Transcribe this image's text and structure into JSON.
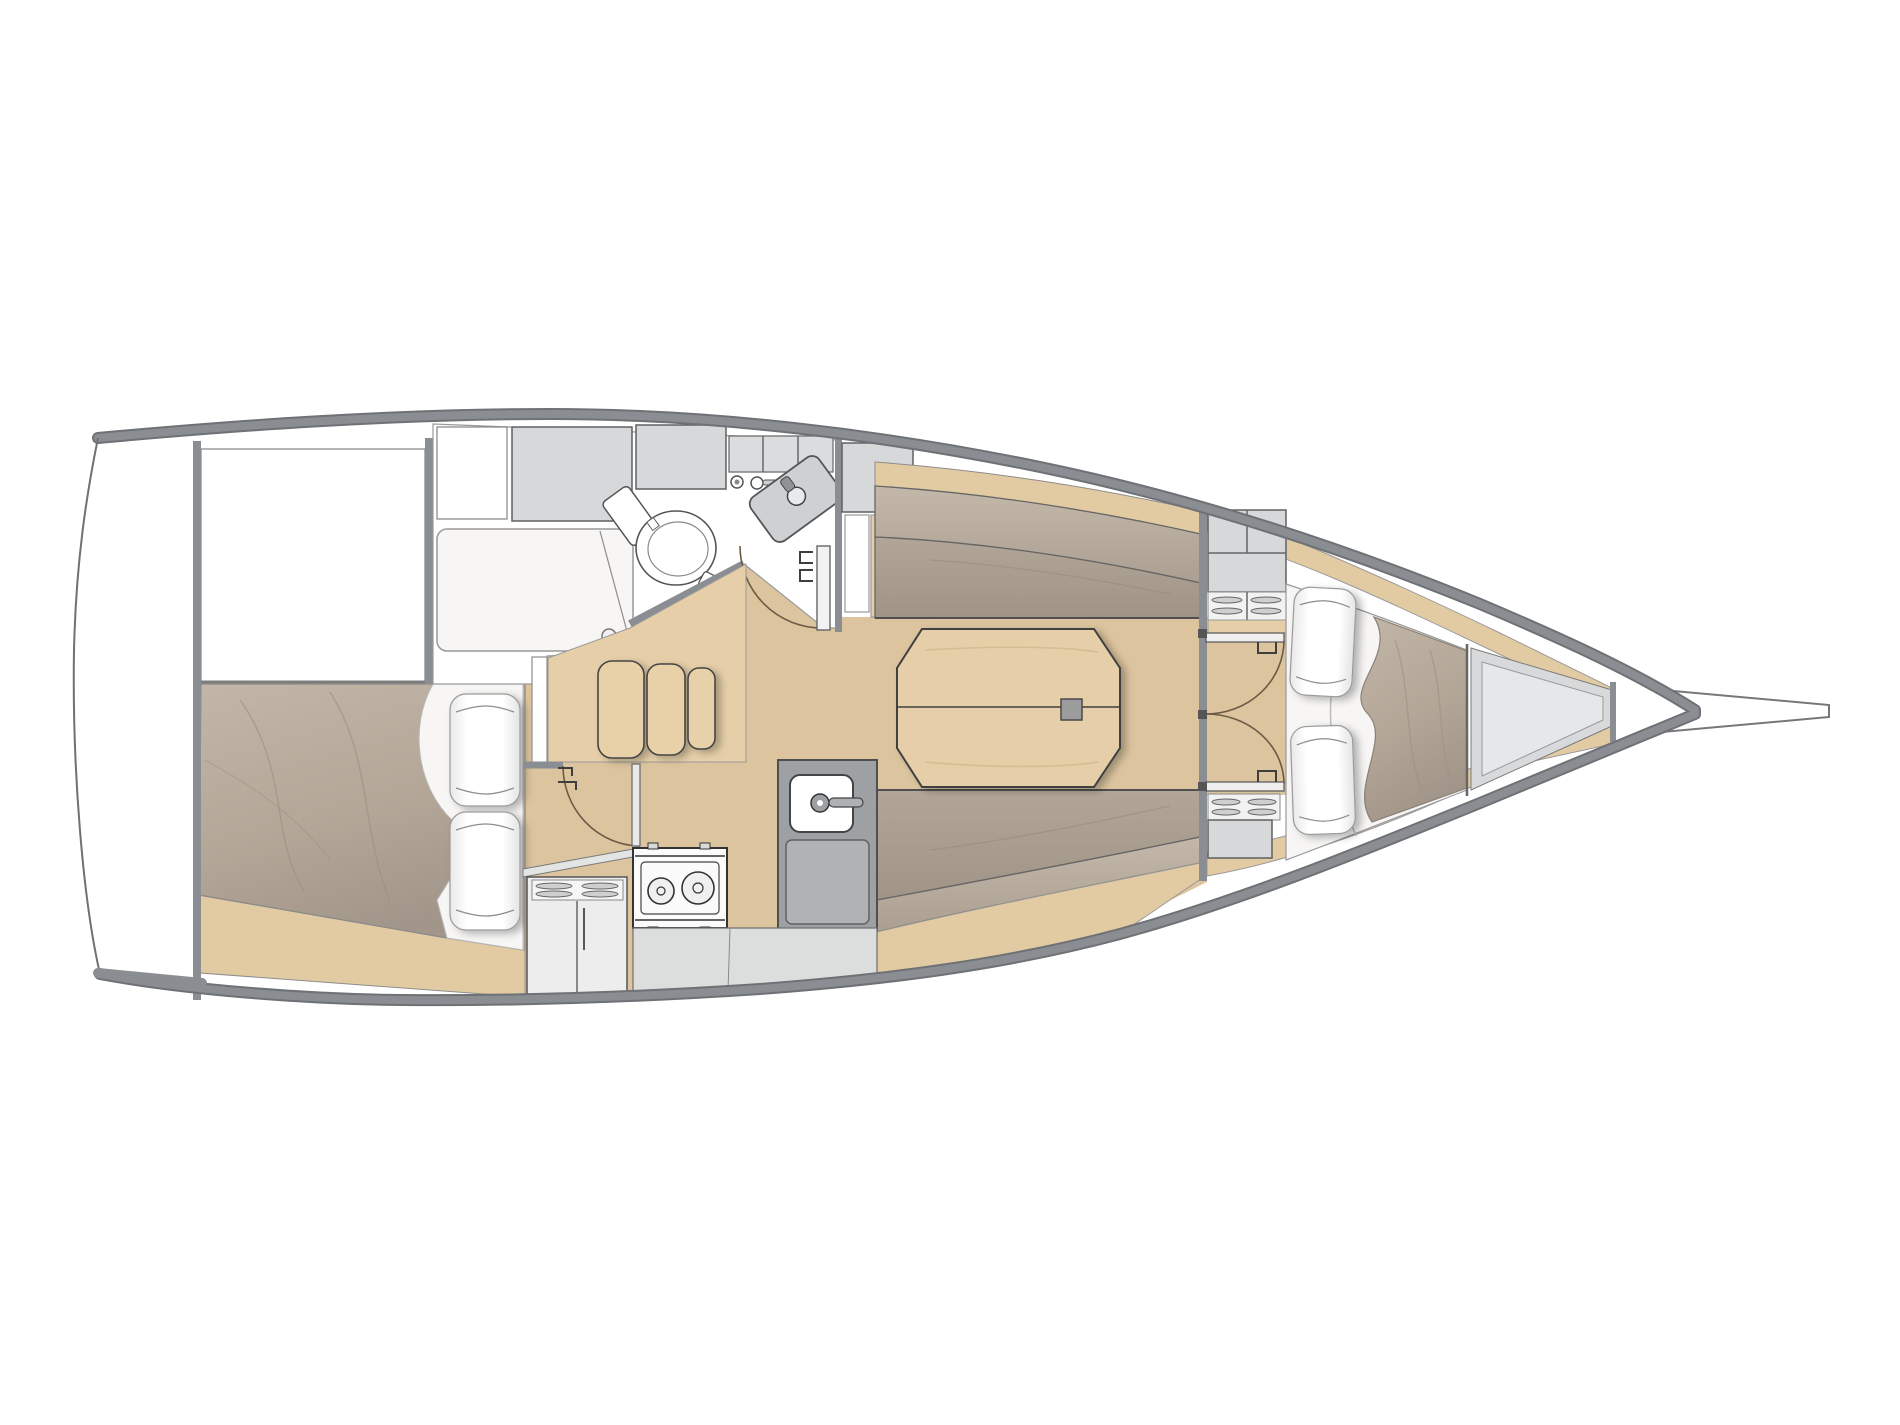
{
  "document": {
    "type": "yacht-interior-floor-plan",
    "orientation": "bow-right",
    "visible_text": ""
  },
  "palette": {
    "background": "#ffffff",
    "hull_edge": "#6e7175",
    "hull_band": "#8a8d91",
    "wall": "#8a8d91",
    "line_dark": "#3f3f3f",
    "line_mid": "#666666",
    "floor_wood": "#dcc49e",
    "furniture_wood": "#e6cfa8",
    "wood_band": "#e2cba3",
    "cabinet_gray": "#d7d8da",
    "cabinet_border": "#5f6163",
    "counter_dark": "#9da1a4",
    "counter_mid": "#b0b3b6",
    "counter_light": "#dcdddd",
    "upholstery": "#a89b8d",
    "upholstery_light": "#bcb0a2",
    "mattress": "#b3a697",
    "white_soft": "#f7f6f4"
  },
  "regions": [
    {
      "name": "transom-platform",
      "items": []
    },
    {
      "name": "aft-cabin",
      "items": [
        "double-berth",
        "pillow",
        "pillow",
        "storage-area"
      ]
    },
    {
      "name": "head",
      "items": [
        "toilet",
        "vanity-sink",
        "shower-pan",
        "upper-cabinets",
        "door"
      ]
    },
    {
      "name": "companionway",
      "items": [
        "steps",
        "aft-cabin-door"
      ]
    },
    {
      "name": "galley",
      "items": [
        "two-burner-stove",
        "galley-sink",
        "faucet",
        "louvered-cabinet",
        "counter"
      ]
    },
    {
      "name": "salon",
      "items": [
        "port-settee",
        "starboard-settee",
        "folding-table",
        "table-fitting",
        "wet-locker"
      ]
    },
    {
      "name": "forward-cabin",
      "items": [
        "v-berth",
        "pillow",
        "pillow",
        "double-doors",
        "cabinet",
        "louvered-vents"
      ]
    },
    {
      "name": "forepeak",
      "items": [
        "anchor-locker"
      ]
    },
    {
      "name": "bowsprit",
      "items": []
    }
  ]
}
